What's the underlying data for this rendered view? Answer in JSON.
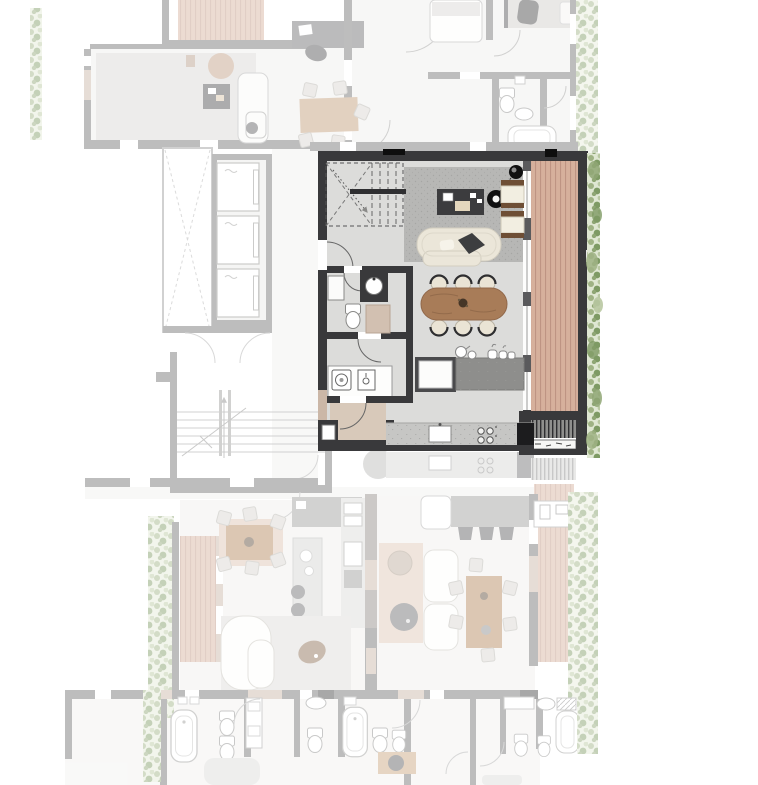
{
  "page": {
    "background": "#ffffff",
    "kind": "architectural floor plan, one apartment highlighted, surroundings faded"
  },
  "plan": {
    "highlighted_unit": {
      "state": "selected",
      "rooms": [
        {
          "name": "internal-stair",
          "items": [
            "dashed-stair-outline",
            "handrail"
          ]
        },
        {
          "name": "living-area",
          "items": [
            "area-rug",
            "media-desk",
            "pendant-light",
            "pendant-light-ring",
            "lounge-chair",
            "lounge-chair",
            "curved-sofa",
            "dark-cushion"
          ]
        },
        {
          "name": "dining-area",
          "items": [
            "oval-wood-table",
            "chair",
            "chair",
            "chair",
            "chair",
            "chair",
            "chair",
            "center-plant"
          ]
        },
        {
          "name": "kitchen",
          "items": [
            "island-slab",
            "island-sink-block",
            "crockery",
            "wall-counter",
            "counter-sink",
            "four-burner-cooktop",
            "tall-dark-cabinet"
          ]
        },
        {
          "name": "wc",
          "items": [
            "toilet",
            "round-washbasin",
            "white-cabinet",
            "beige-cabinet"
          ]
        },
        {
          "name": "laundry",
          "items": [
            "washer",
            "laundry-sink",
            "counter"
          ]
        },
        {
          "name": "entry-hall",
          "items": [
            "door-swing"
          ]
        },
        {
          "name": "balcony",
          "items": [
            "timber-deck",
            "glazing-wall",
            "external-stair",
            "grate-strip"
          ]
        }
      ]
    },
    "context": {
      "core": [
        "shaft-void",
        "elevator",
        "elevator",
        "elevator",
        "main-stairwell",
        "corridor"
      ],
      "neighboring_areas": [
        "upper-left-apartment",
        "upper-terrace-deck",
        "upper-right-bedrooms",
        "upper-right-bathroom",
        "lower-left-apartment",
        "lower-right-apartment",
        "bottom-bathroom-band"
      ],
      "landscape": [
        "planting-strip-left-top",
        "planting-strip-left-bottom",
        "planting-strip-right",
        "planting-strip-bottom-right",
        "timber-decks"
      ]
    },
    "palette": {
      "wall_dark": "#39393b",
      "wall_black": "#0e0e0e",
      "wall_faded": "#6f6f6f",
      "floor_light": "#dcdcda",
      "rug_gray": "#b7b7b5",
      "wood_table": "#a87c58",
      "deck_timber": "#d6b09c",
      "deck_joint": "#bb9180",
      "cream_upholstery": "#ebe6d9",
      "beige_accent": "#d4c3b4",
      "island_gray": "#8e8e8c",
      "counter_concrete": "#c6c6c4",
      "foliage_light": "#b9c8a2",
      "foliage_mid": "#9fb284",
      "foliage_dark": "#7e9a64",
      "fixture_white": "#ffffff"
    },
    "fade_opacity": 0.45
  },
  "aria": {
    "plan": "Residential floor plan drawing",
    "unit": "Highlighted apartment unit with living, dining, kitchen, wc, laundry and balcony",
    "core": "Building core with elevators, shaft void and stairwell",
    "surroundings": "Faded neighboring apartments and bathrooms",
    "landscape": "Planting strip along the highlighted balcony"
  }
}
